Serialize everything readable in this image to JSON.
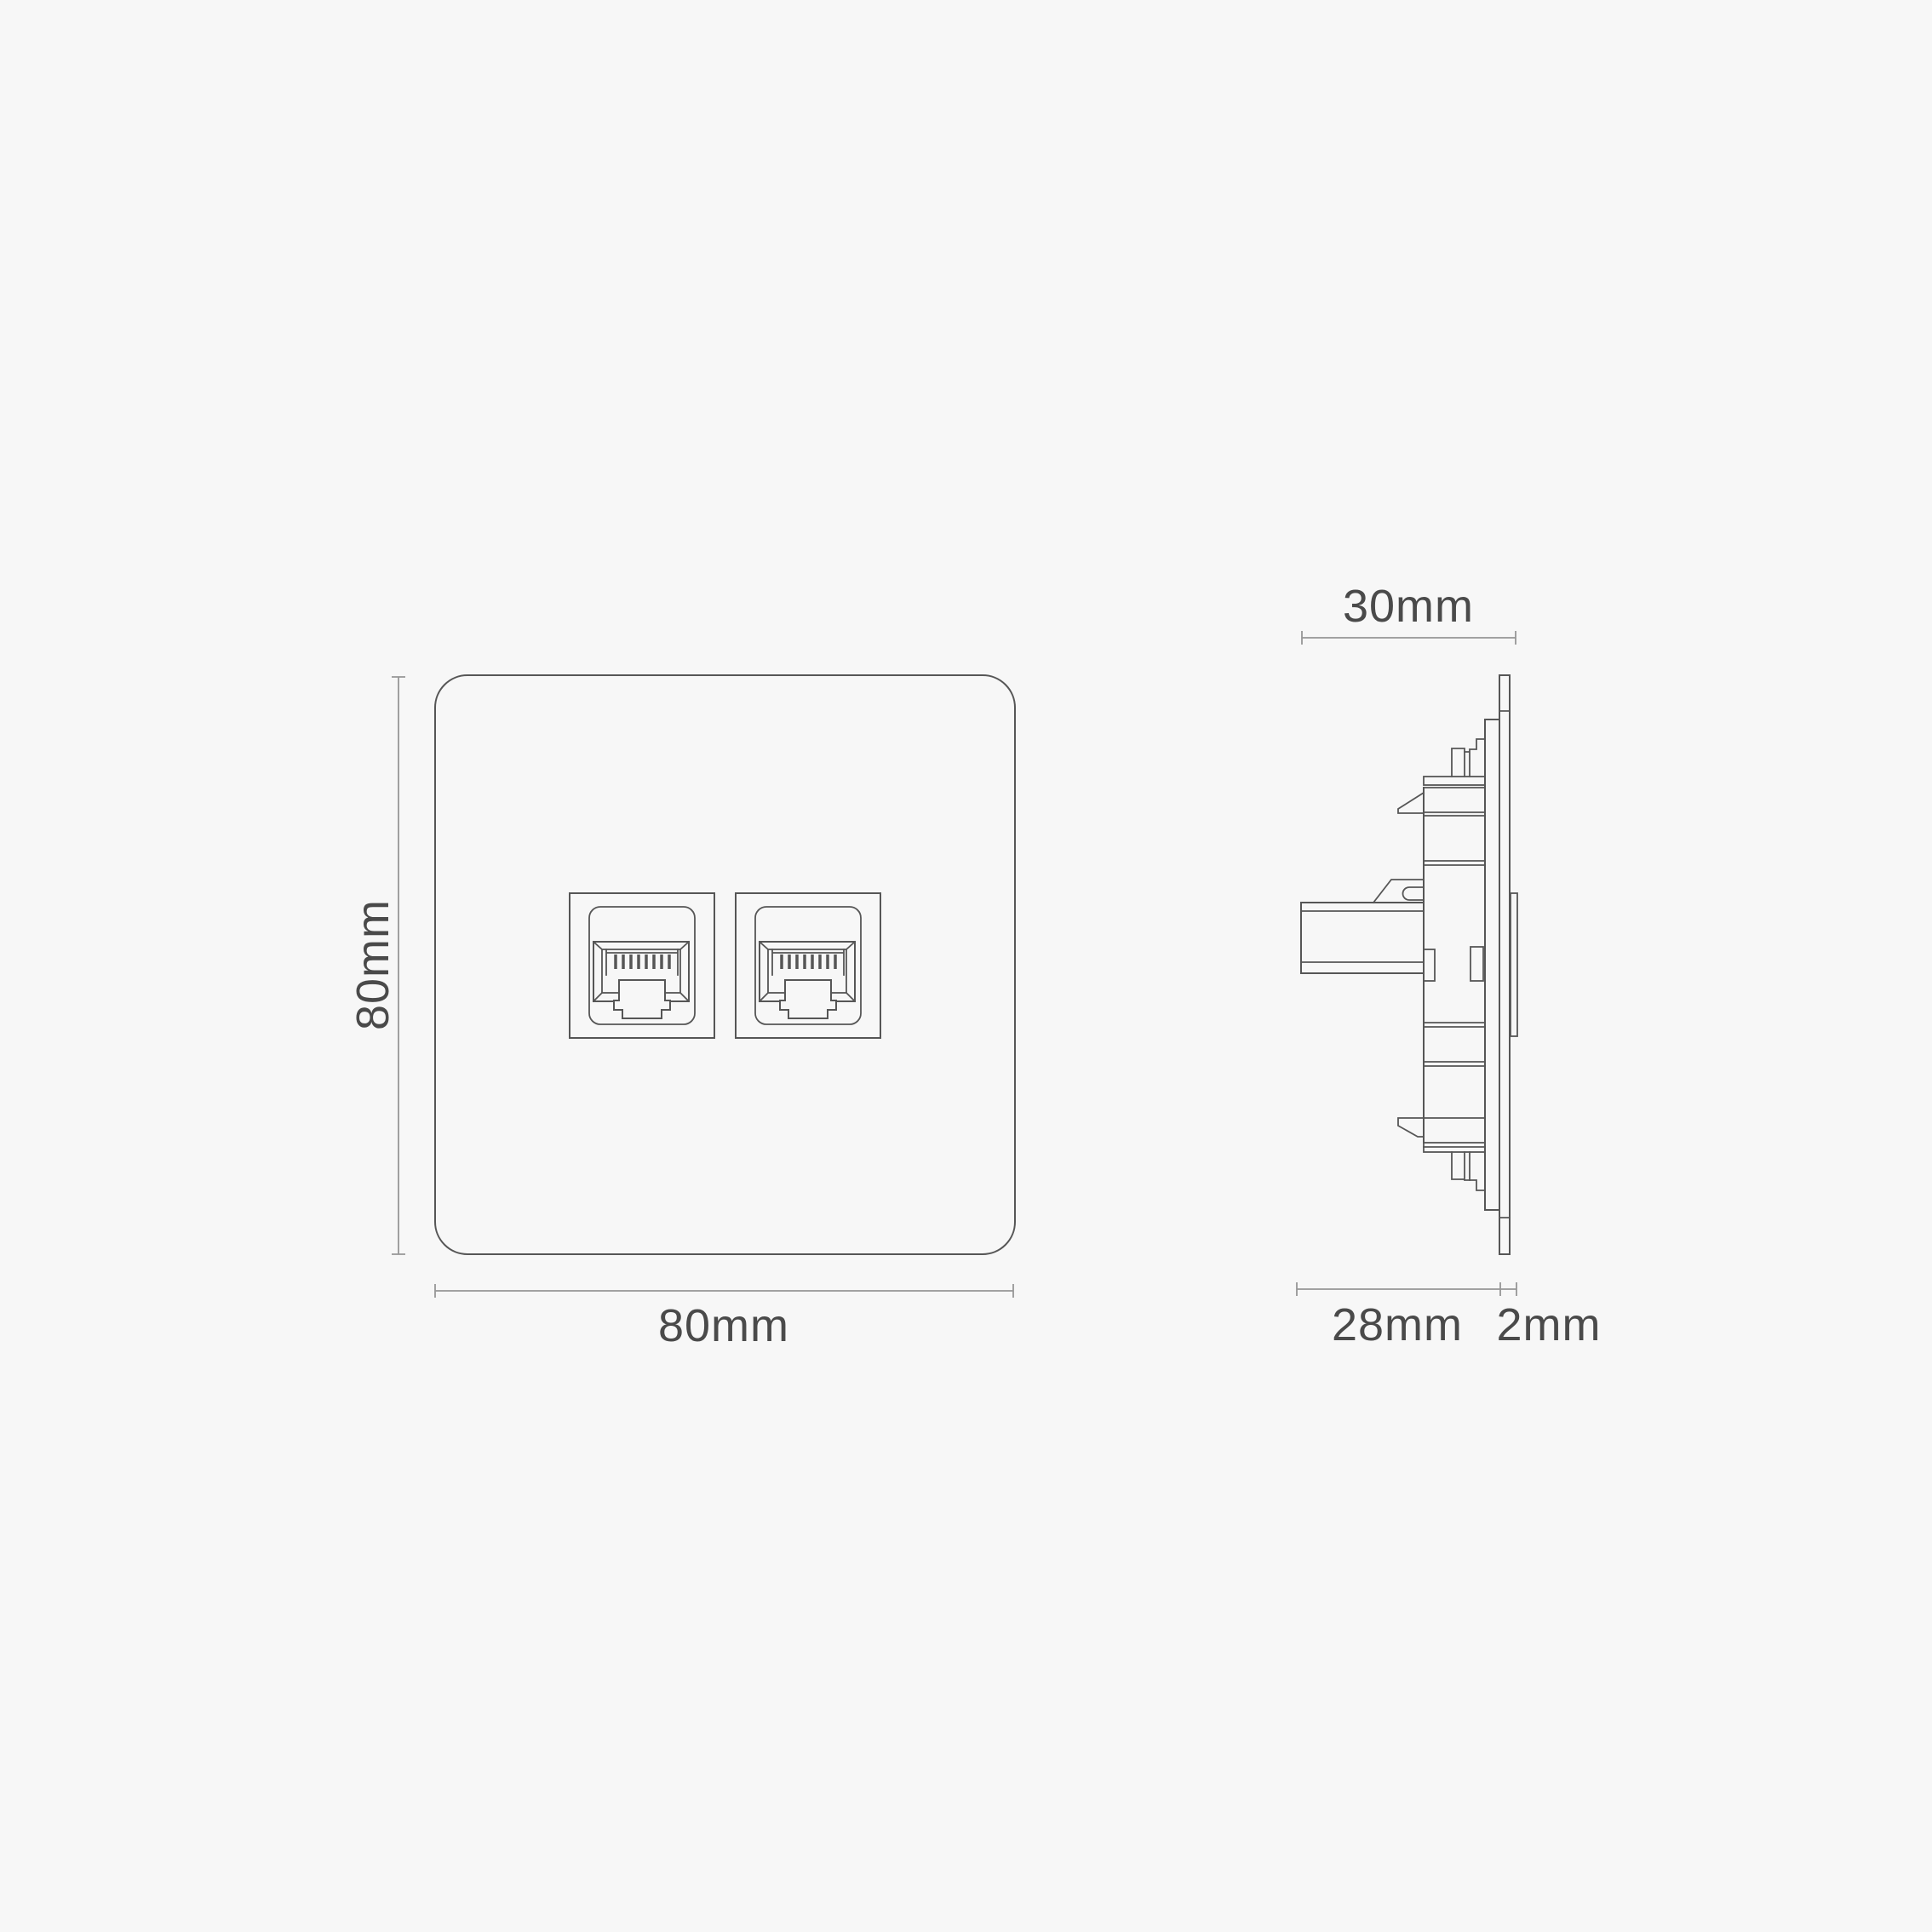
{
  "labels": {
    "front_height": "80mm",
    "front_width": "80mm",
    "side_depth": "30mm",
    "side_module_depth": "28mm",
    "side_plate_thickness": "2mm"
  },
  "colors": {
    "background": "#f7f7f7",
    "outline": "#565656",
    "dimension_line": "#979797",
    "dimension_text": "#4a4a4a"
  }
}
